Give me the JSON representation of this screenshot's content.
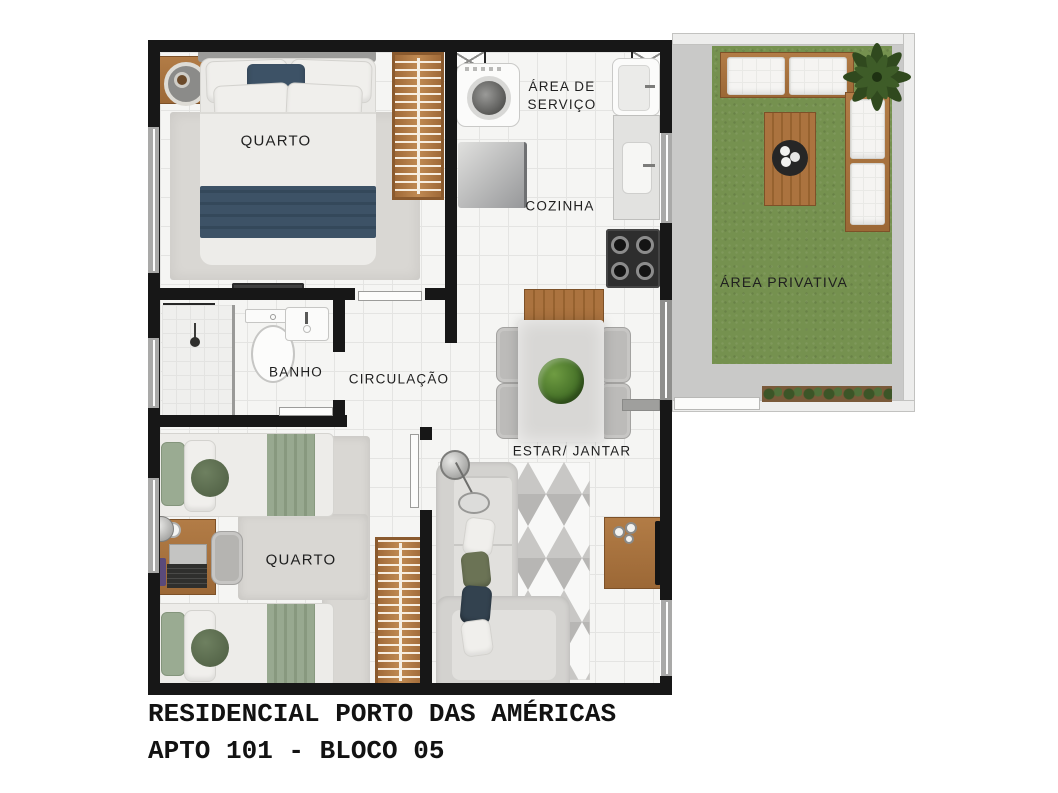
{
  "title": {
    "line1": "RESIDENCIAL PORTO DAS AMÉRICAS",
    "line2": "APTO 101 - BLOCO 05"
  },
  "rooms": {
    "bedroom1": {
      "label": "QUARTO"
    },
    "service": {
      "label": "ÁREA DE SERVIÇO"
    },
    "kitchen": {
      "label": "COZINHA"
    },
    "private": {
      "label": "ÁREA PRIVATIVA"
    },
    "bathroom": {
      "label": "BANHO"
    },
    "hallway": {
      "label": "CIRCULAÇÃO"
    },
    "living": {
      "label": "ESTAR/ JANTAR"
    },
    "bedroom2": {
      "label": "QUARTO"
    }
  },
  "colors": {
    "wall": "#171717",
    "floor": "#f5f5f3",
    "grass": "#75914f",
    "concrete": "#c9c9c8",
    "wood": "#ab733f",
    "wood_dark": "#8f5e30",
    "teal": "#3d5266",
    "sage": "#98a990",
    "rug": "#d9d7d3",
    "sofa": "#d3d2cf",
    "white_wall": "#ededec"
  }
}
